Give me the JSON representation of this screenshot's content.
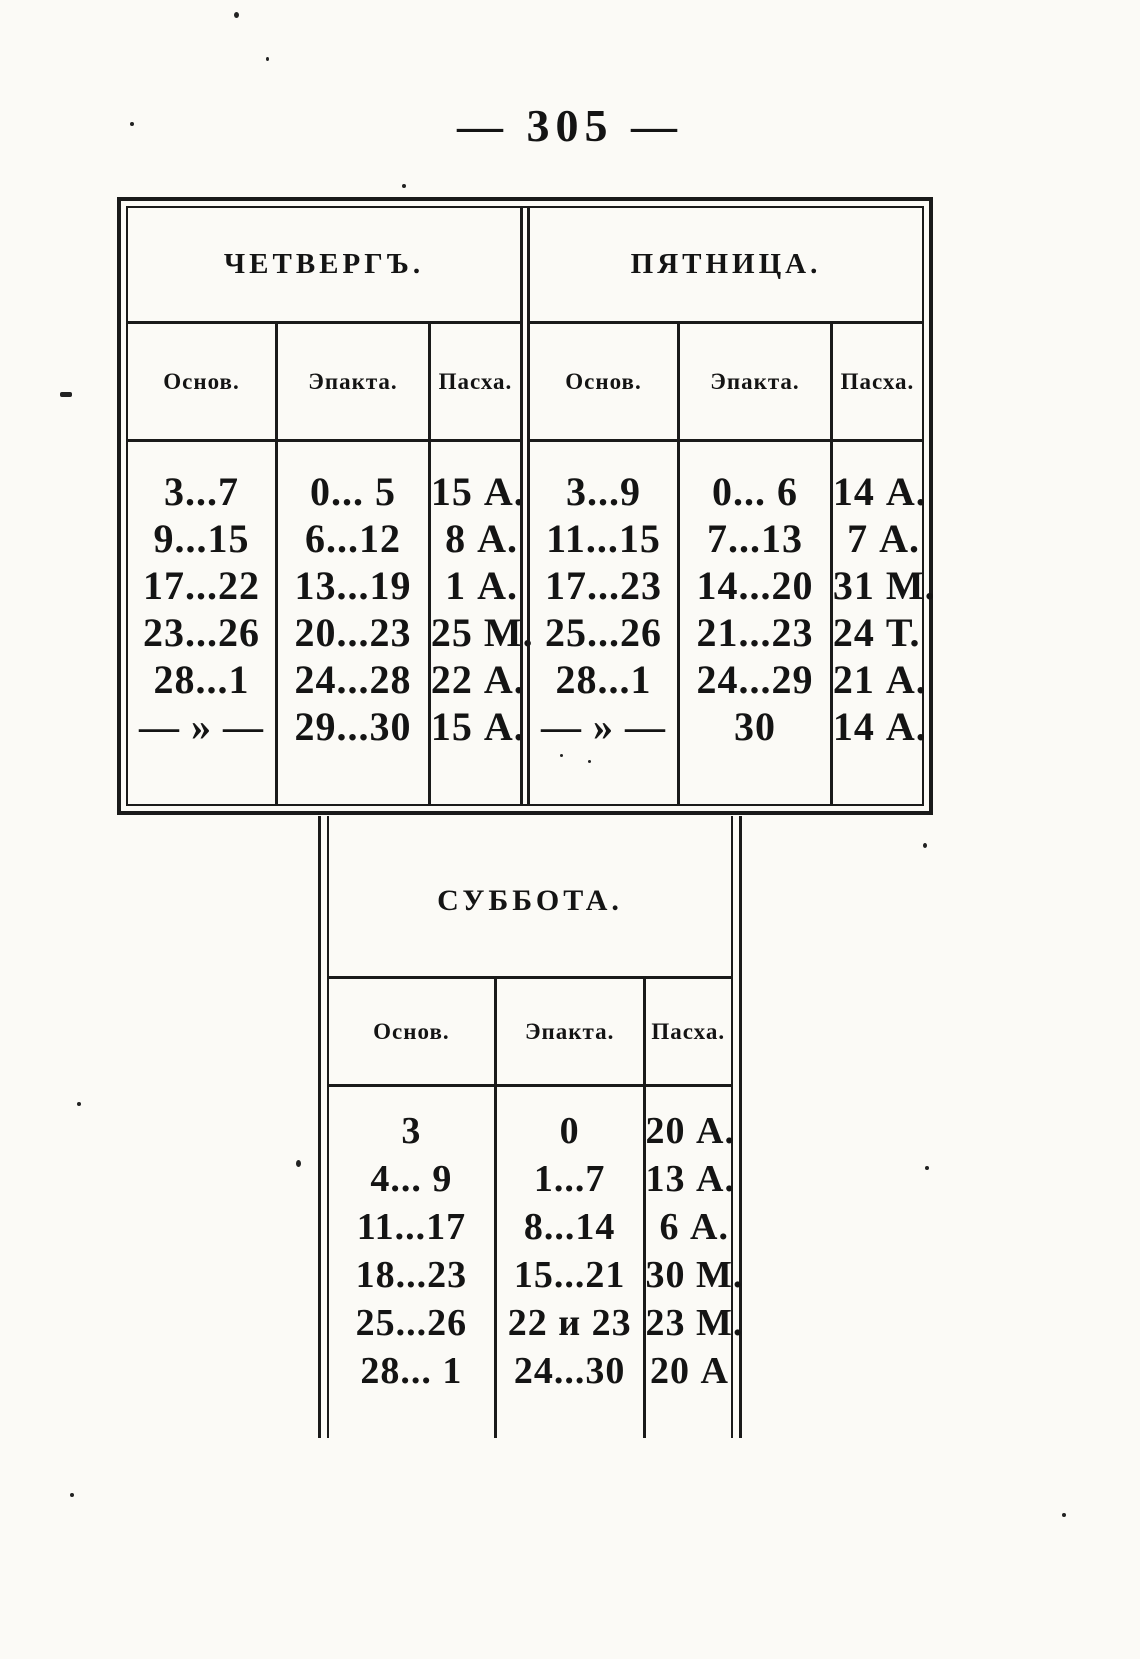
{
  "page": {
    "number_label": "— 305 —"
  },
  "tables": {
    "thursday": {
      "title": "ЧЕТВЕРГЪ.",
      "columns": [
        "Основ.",
        "Эпакта.",
        "Пасха."
      ],
      "rows": [
        [
          "3...7",
          "0... 5",
          "15 А."
        ],
        [
          "9...15",
          "6...12",
          "8 А."
        ],
        [
          "17...22",
          "13...19",
          "1 А."
        ],
        [
          "23...26",
          "20...23",
          "25 М."
        ],
        [
          "28...1",
          "24...28",
          "22 А."
        ],
        [
          "— » —",
          "29...30",
          "15 А."
        ]
      ]
    },
    "friday": {
      "title": "ПЯТНИЦА.",
      "columns": [
        "Основ.",
        "Эпакта.",
        "Пасха."
      ],
      "rows": [
        [
          "3...9",
          "0... 6",
          "14 А."
        ],
        [
          "11...15",
          "7...13",
          "7 А."
        ],
        [
          "17...23",
          "14...20",
          "31 М."
        ],
        [
          "25...26",
          "21...23",
          "24 Т."
        ],
        [
          "28...1",
          "24...29",
          "21 А."
        ],
        [
          "— » —",
          "30",
          "14 А."
        ]
      ]
    },
    "saturday": {
      "title": "СУББОТА.",
      "columns": [
        "Основ.",
        "Эпакта.",
        "Пасха."
      ],
      "rows": [
        [
          "3",
          "0",
          "20 А."
        ],
        [
          "4... 9",
          "1...7",
          "13 А."
        ],
        [
          "11...17",
          "8...14",
          "6 А."
        ],
        [
          "18...23",
          "15...21",
          "30 М."
        ],
        [
          "25...26",
          "22 и 23",
          "23 М."
        ],
        [
          "28... 1",
          "24...30",
          "20 А"
        ]
      ]
    }
  }
}
